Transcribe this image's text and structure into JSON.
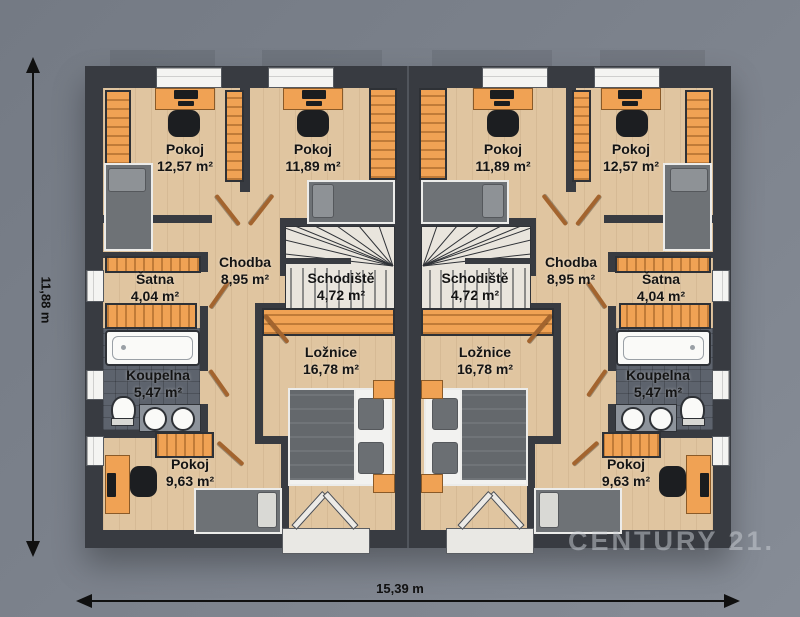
{
  "rooms": {
    "pokoj_a": {
      "name": "Pokoj",
      "area": "12,57 m²"
    },
    "pokoj_b": {
      "name": "Pokoj",
      "area": "11,89 m²"
    },
    "chodba": {
      "name": "Chodba",
      "area": "8,95 m²"
    },
    "schodiste": {
      "name": "Schodiště",
      "area": "4,72 m²"
    },
    "satna": {
      "name": "Šatna",
      "area": "4,04 m²"
    },
    "koupelna": {
      "name": "Koupelna",
      "area": "5,47 m²"
    },
    "loznice": {
      "name": "Ložnice",
      "area": "16,78 m²"
    },
    "pokoj_c": {
      "name": "Pokoj",
      "area": "9,63 m²"
    }
  },
  "dimensions": {
    "height_label": "11,88 m",
    "width_label": "15,39 m"
  },
  "watermark": "CENTURY 21.",
  "colors": {
    "background": "#7b818b",
    "wall": "#383b41",
    "floor_wood": "#e0c5a0",
    "furniture_orange": "#f0a254",
    "bathroom_tile": "#5d636d",
    "stairs": "#e9e5dd",
    "dimension_line": "#101010",
    "watermark_gray": "#ccd0d6"
  }
}
